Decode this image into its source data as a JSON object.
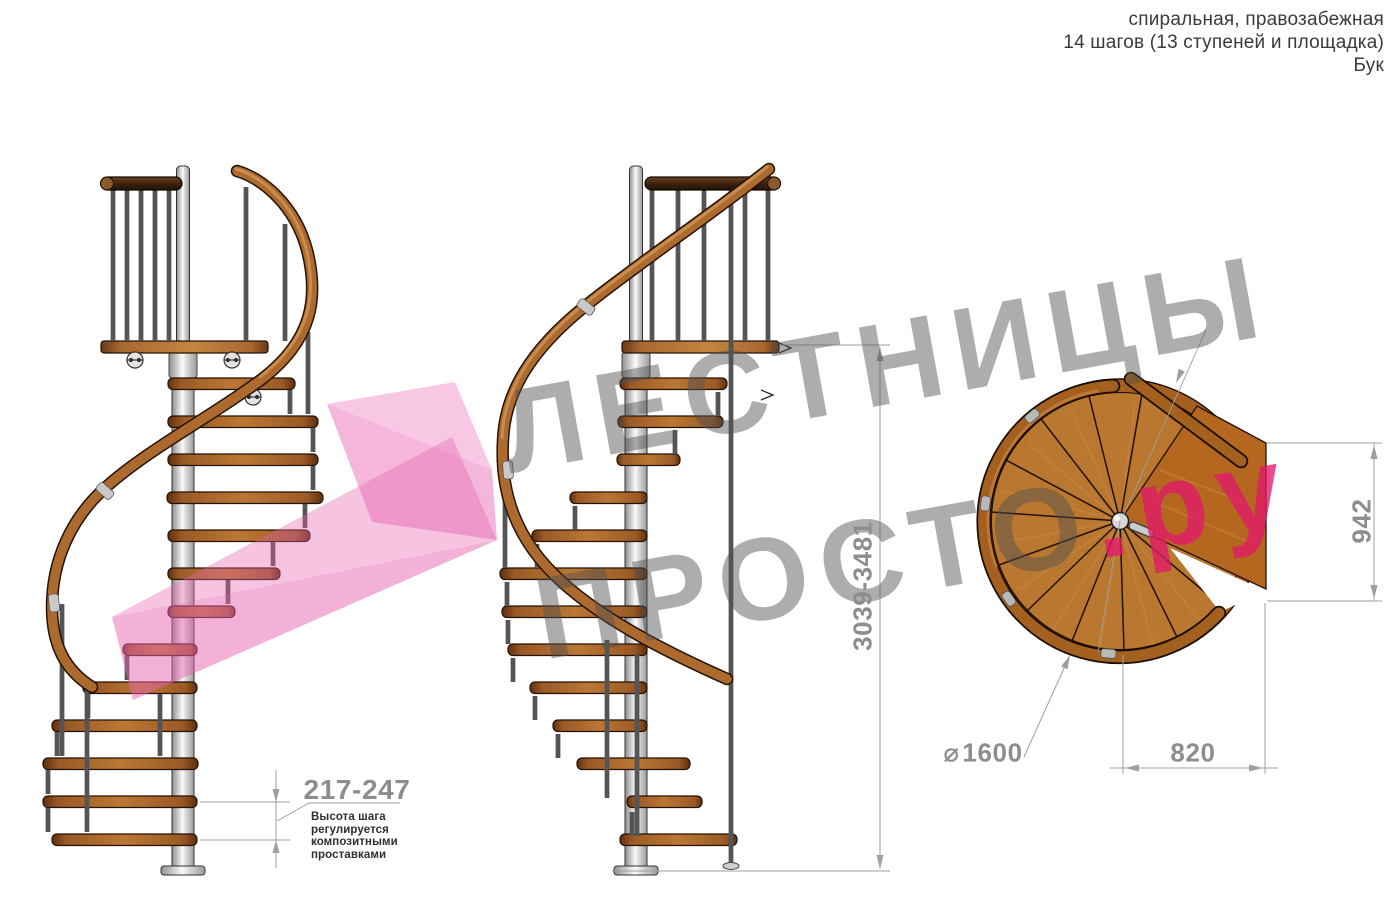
{
  "header": {
    "line1": "спиральная, правозабежная",
    "line2": "14 шагов (13 ступеней и площадка)",
    "line3": "Бук"
  },
  "dimensions": {
    "step_height": "217-247",
    "step_height_note_lines": [
      "Высота шага",
      "регулируется",
      "композитными",
      "проставками"
    ],
    "total_height": "3039-3481",
    "landing_depth": "942",
    "step_length": "820",
    "diameter_symbol": "⌀",
    "diameter_value": "1600"
  },
  "watermark": {
    "line1": "ЛЕСТНИЦЫ",
    "line2_gray": "ПРОСТО",
    "line2_accent": ".ру"
  },
  "views": {
    "left_elevation": "side view",
    "center_elevation": "side view rotated",
    "plan": "top view"
  },
  "colors": {
    "wood_mid": "#bb7733",
    "wood_dark": "#5f2f10",
    "handrail": "#ad6a2e",
    "dark_rail": "#3a200d",
    "metal": "#d2d2d2",
    "dimension_gray": "#8d8d8d",
    "text_dark": "#3a3a3a",
    "watermark_gray": "#505050",
    "watermark_pink": "#e863b1",
    "accent_pink": "#e11969"
  }
}
